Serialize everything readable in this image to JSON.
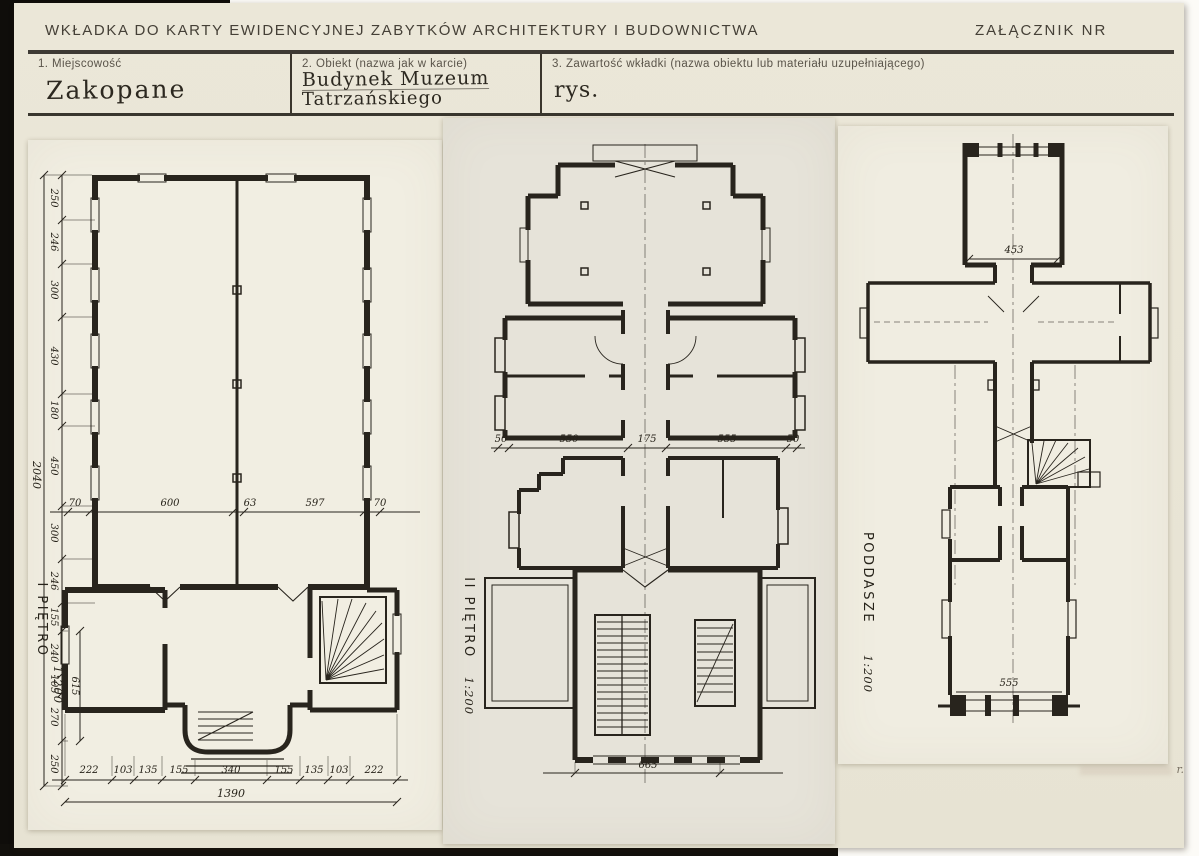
{
  "header": {
    "title": "WKŁADKA DO KARTY EWIDENCYJNEJ ZABYTKÓW ARCHITEKTURY I BUDOWNICTWA",
    "attachment_label": "ZAŁĄCZNIK NR"
  },
  "form": {
    "field1": {
      "label": "1. Miejscowość",
      "value": "Zakopane"
    },
    "field2": {
      "label": "2. Obiekt (nazwa jak w karcie)",
      "value_line1": "Budynek Muzeum",
      "value_line2": "Tatrzańskiego"
    },
    "field3": {
      "label": "3. Zawartość wkładki (nazwa obiektu lub materiału uzupełniającego)",
      "value": "rys."
    }
  },
  "plans": {
    "first_floor": {
      "name": "I PIĘTRO",
      "scale": "1:200",
      "left_dims": [
        "250",
        "246",
        "300",
        "430",
        "180",
        "450",
        "300",
        "246",
        "155",
        "240",
        "105",
        "270",
        "250"
      ],
      "left_total": "2040",
      "left_subtotal": "615",
      "mid_dims": [
        "70",
        "600",
        "63",
        "597",
        "70"
      ],
      "bottom_dims": [
        "222",
        "103",
        "135",
        "155",
        "340",
        "155",
        "135",
        "103",
        "222"
      ],
      "bottom_total": "1390"
    },
    "second_floor": {
      "name": "II PIĘTRO",
      "scale": "1:200",
      "width_dims": [
        "50",
        "550",
        "175",
        "555",
        "50"
      ],
      "bottom_total": "665"
    },
    "attic": {
      "name": "PODDASZE",
      "scale": "1:200",
      "top_room_width": "453",
      "bottom_room_width": "555"
    }
  },
  "stamp": {
    "text": "r."
  },
  "colors": {
    "paper": "#e9e5d6",
    "panel": "#f1eee2",
    "ink": "#28241d"
  }
}
